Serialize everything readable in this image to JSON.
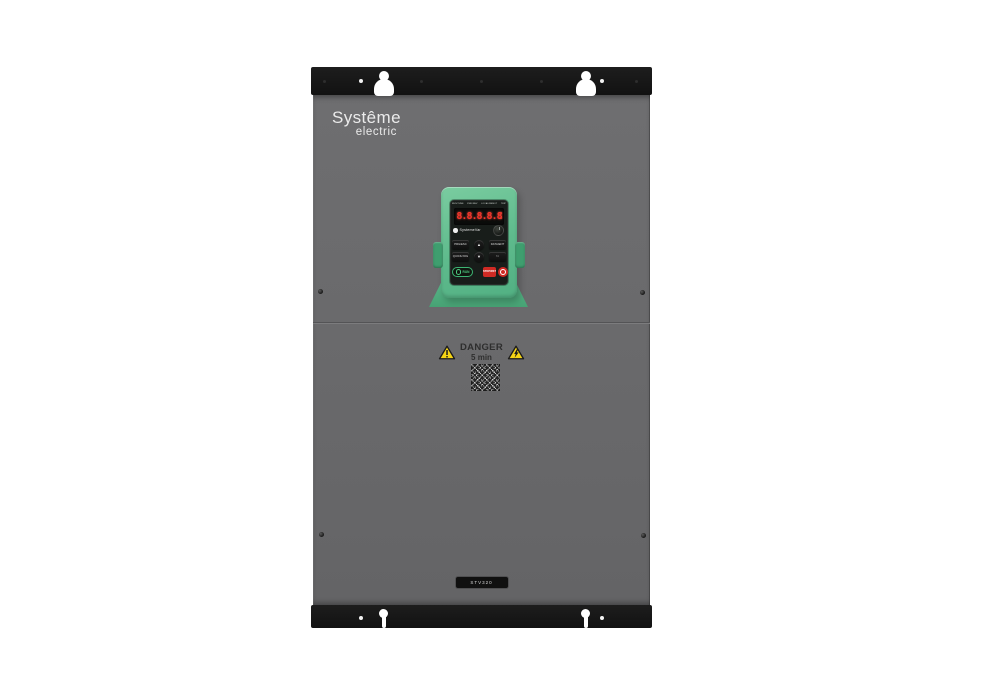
{
  "brand": {
    "line1": "Systême",
    "line2": "electric"
  },
  "keypad": {
    "indicators": [
      "RUN/TUNE",
      "FWD/REV",
      "LOCAL/REMOT",
      "TRIP"
    ],
    "display_value": "8.8.8.8.8",
    "brand_text": "SystemeVar",
    "buttons": {
      "prg_esc": "PRG/ESC",
      "quick_jog": "QUICK/JOG",
      "up": "▲",
      "down": "▼",
      "data_ent": "DATA/ENT",
      "shift": ">>",
      "run": "RUN",
      "stop": "STOP/RST"
    }
  },
  "warning": {
    "title": "DANGER",
    "subtitle": "5 min"
  },
  "model_label": "STV320",
  "colors": {
    "body_gray": "#6a6a6c",
    "bracket_black": "#171717",
    "keypad_green": "#5eba8c",
    "display_red": "#f5352b",
    "warning_yellow": "#f6d515"
  }
}
